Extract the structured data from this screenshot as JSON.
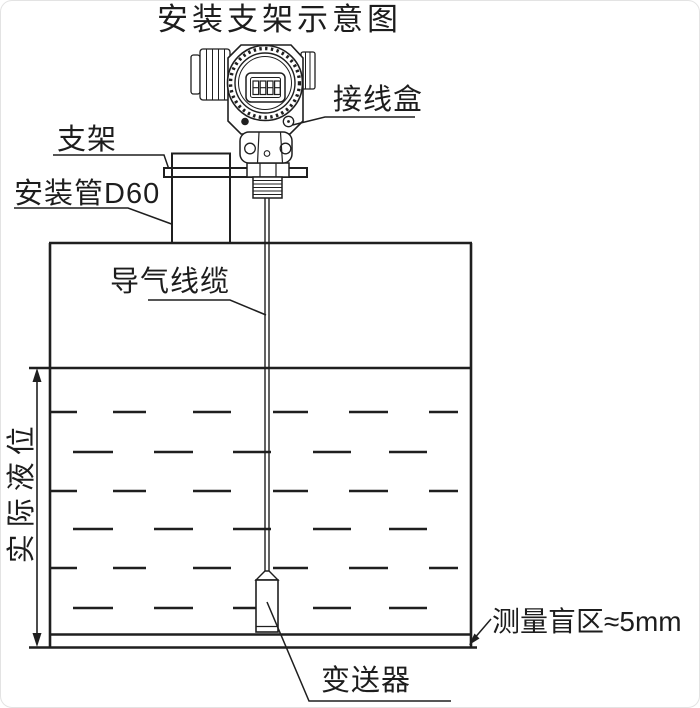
{
  "title": "安装支架示意图",
  "labels": {
    "junction_box": "接线盒",
    "bracket": "支架",
    "mounting_pipe": "安装管D60",
    "air_cable": "导气线缆",
    "actual_level": "实际液位",
    "blind_zone": "测量盲区≈5mm",
    "transmitter": "变送器"
  },
  "lcd_digits": "8888",
  "colors": {
    "line": "#1f1f1f",
    "background": "#ffffff"
  }
}
